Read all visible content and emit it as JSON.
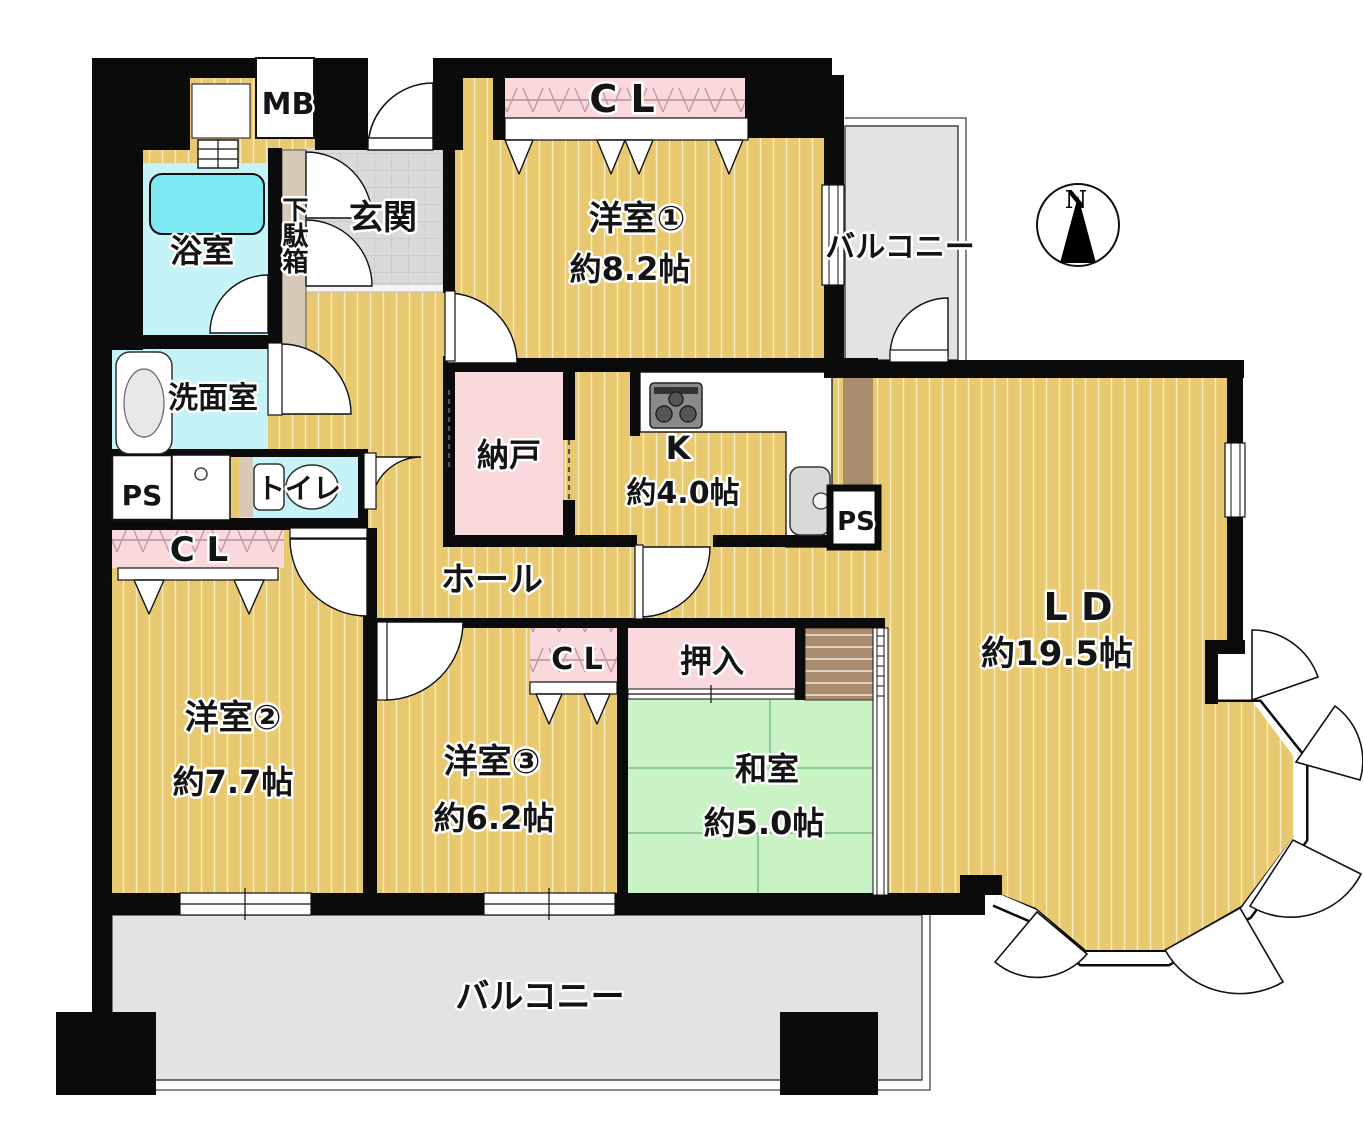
{
  "document": {
    "kind": "japanese-apartment-floor-plan"
  },
  "colors": {
    "wall": "#0b0b0b",
    "wood": "#e9c96f",
    "wood_stripe": "#f8ecc4",
    "tatami_green": "#c9f2c5",
    "tatami_line": "#8fca9c",
    "closet_pink": "#f9d9dc",
    "service_cyan": "#c5f3f7",
    "tub_cyan": "#7de9f2",
    "tile_gray": "#dcd9da",
    "tile_line": "#c6c3c4",
    "balcony_gray": "#e3e3e3",
    "trim_brown": "#a98c6e",
    "cabinet_beige": "#d6c9b8",
    "fixture_gray": "#d9d9d9",
    "stove_gray": "#8a8a8a"
  },
  "labels": {
    "meter_box": "MB",
    "bathroom": "浴室",
    "washroom": "洗面室",
    "toilet": "トイレ",
    "pipe_space_left": "PS",
    "pipe_space_kitchen": "PS",
    "shoe_cabinet": "下駄箱",
    "entrance": "玄関",
    "hall": "ホール",
    "storage_room": "納戸",
    "closet_hall": "C L",
    "closet_ws1": "C L",
    "closet_ws3": "C L",
    "kitchen": "K",
    "kitchen_size": "約4.0帖",
    "western_room_1": "洋室①",
    "western_room_1_size": "約8.2帖",
    "western_room_2": "洋室②",
    "western_room_2_size": "約7.7帖",
    "western_room_3": "洋室③",
    "western_room_3_size": "約6.2帖",
    "japanese_room": "和室",
    "japanese_room_size": "約5.0帖",
    "oshiire_closet": "押入",
    "living_dining": "L D",
    "living_dining_size": "約19.5帖",
    "balcony_top": "バルコニー",
    "balcony_bottom": "バルコニー",
    "compass_north": "N"
  }
}
